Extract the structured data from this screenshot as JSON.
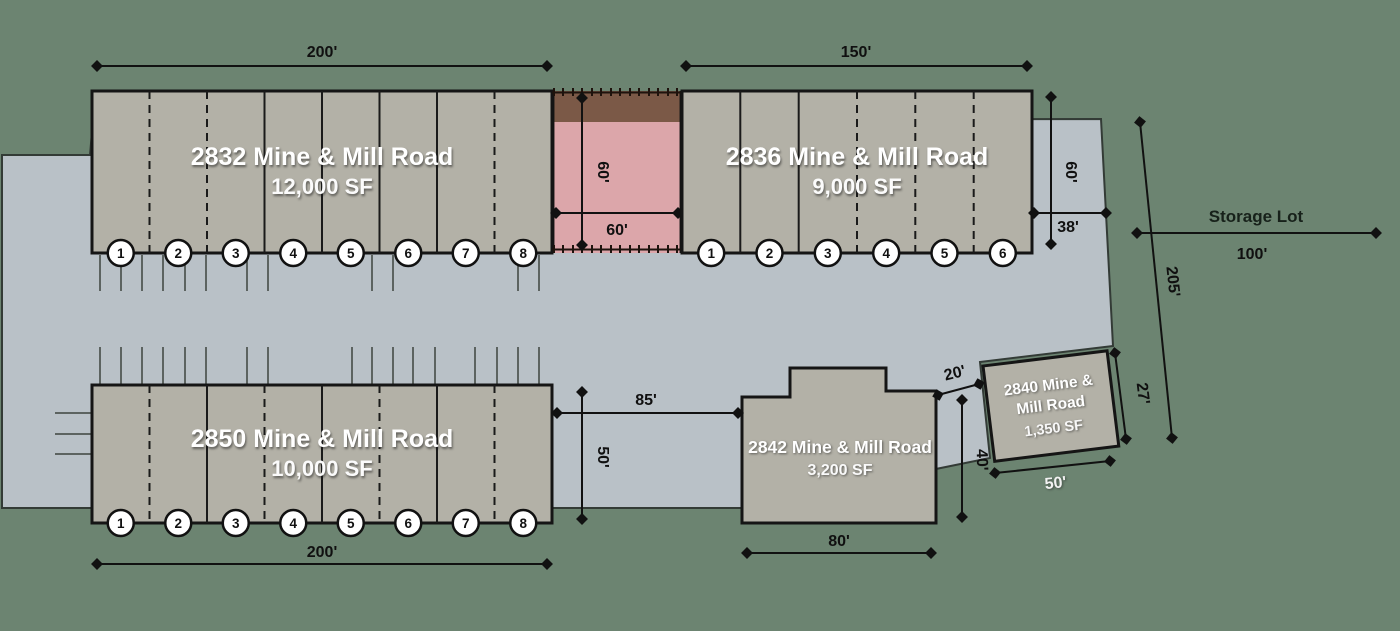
{
  "colors": {
    "background": "#6c8471",
    "pavement": "#b9c1c7",
    "building": "#b3b1a7",
    "highlight": "#dca6aa",
    "highlight_dark": "#7b5947"
  },
  "buildings": {
    "b2832": {
      "name": "2832 Mine & Mill Road",
      "size": "12,000 SF",
      "width_dim": "200'",
      "units": [
        "1",
        "2",
        "3",
        "4",
        "5",
        "6",
        "7",
        "8"
      ]
    },
    "b2836": {
      "name": "2836 Mine & Mill Road",
      "size": "9,000 SF",
      "width_dim": "150'",
      "units": [
        "1",
        "2",
        "3",
        "4",
        "5",
        "6"
      ]
    },
    "b2850": {
      "name": "2850 Mine & Mill Road",
      "size": "10,000 SF",
      "width_dim": "200'",
      "units": [
        "1",
        "2",
        "3",
        "4",
        "5",
        "6",
        "7",
        "8"
      ]
    },
    "b2842": {
      "name": "2842 Mine & Mill Road",
      "size": "3,200 SF",
      "width_dim": "80'"
    },
    "b2840": {
      "name_line1": "2840 Mine &",
      "name_line2": "Mill Road",
      "size": "1,350 SF",
      "width_dim": "50'"
    }
  },
  "highlight_unit": {
    "depth_dim": "60'",
    "width_dim": "60'"
  },
  "dims": {
    "right_depth": "60'",
    "right_offset": "38'",
    "frontage": "205'",
    "drive_width": "85'",
    "drive_depth": "50'",
    "gap": "20'",
    "side_40": "40'",
    "side_27": "27'"
  },
  "storage_lot": {
    "label": "Storage Lot",
    "dim": "100'"
  }
}
